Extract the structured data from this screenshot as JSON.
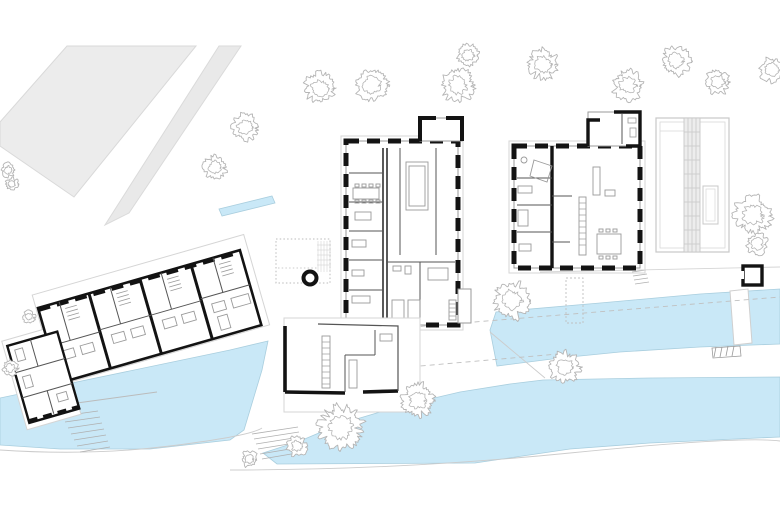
{
  "title": "architectural-site-plan",
  "colors": {
    "paper": "#ffffff",
    "water": "#c9e8f7",
    "waterEdge": "#a9cede",
    "field": "#ececec",
    "fieldEdge": "#d9d9d9",
    "road": "#e9e9e9",
    "roadEdge": "#dadada",
    "wall": "#131313",
    "thinWall": "#555555",
    "lightLine": "#cfcfcf",
    "midLine": "#9a9a9a",
    "treeLine": "#b5b5b5",
    "glassStrip": "#ededed"
  },
  "trees": [
    {
      "x": 320,
      "y": 88,
      "r": 17
    },
    {
      "x": 372,
      "y": 85,
      "r": 18
    },
    {
      "x": 458,
      "y": 85,
      "r": 18
    },
    {
      "x": 468,
      "y": 55,
      "r": 12
    },
    {
      "x": 543,
      "y": 64,
      "r": 17
    },
    {
      "x": 628,
      "y": 85,
      "r": 17
    },
    {
      "x": 676,
      "y": 61,
      "r": 16
    },
    {
      "x": 718,
      "y": 82,
      "r": 14
    },
    {
      "x": 772,
      "y": 70,
      "r": 14
    },
    {
      "x": 245,
      "y": 127,
      "r": 15
    },
    {
      "x": 215,
      "y": 167,
      "r": 13
    },
    {
      "x": 8,
      "y": 170,
      "r": 8
    },
    {
      "x": 12,
      "y": 184,
      "r": 7
    },
    {
      "x": 512,
      "y": 300,
      "r": 20
    },
    {
      "x": 753,
      "y": 215,
      "r": 21
    },
    {
      "x": 757,
      "y": 244,
      "r": 12
    },
    {
      "x": 565,
      "y": 367,
      "r": 17
    },
    {
      "x": 341,
      "y": 427,
      "r": 24
    },
    {
      "x": 418,
      "y": 400,
      "r": 18
    },
    {
      "x": 297,
      "y": 446,
      "r": 11
    },
    {
      "x": 249,
      "y": 459,
      "r": 9
    },
    {
      "x": 10,
      "y": 368,
      "r": 9
    },
    {
      "x": 29,
      "y": 317,
      "r": 7
    }
  ],
  "symbols": {
    "well_circle": {
      "x": 310,
      "y": 278,
      "r": 6.5
    },
    "shed_square": {
      "x": 743,
      "y": 266,
      "w": 19,
      "h": 19
    }
  }
}
